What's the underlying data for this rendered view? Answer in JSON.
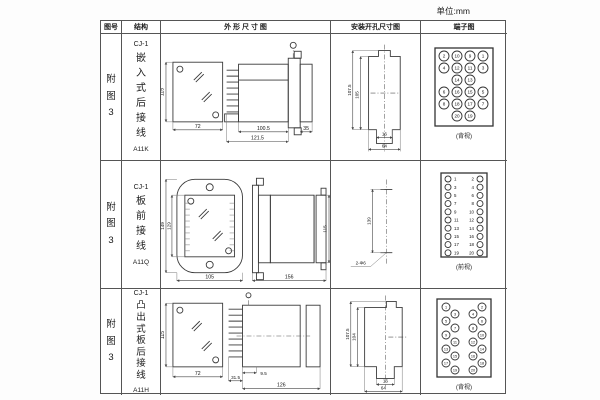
{
  "unit_label": "单位:mm",
  "table": {
    "headers": [
      "图号",
      "结构",
      "外 形 尺 寸 图",
      "安装开孔尺寸图",
      "端子图"
    ]
  },
  "rows": [
    {
      "fig_no": "附图3",
      "structure": {
        "model": "CJ-1",
        "type": "嵌入式后接线",
        "code": "A11K"
      },
      "outline": {
        "front_h": "115",
        "front_w": "72",
        "body": "100.5",
        "total": "121.5",
        "flange": "35"
      },
      "install": {
        "v1": "107.5",
        "v2": "105",
        "w1": "16",
        "w2": "64"
      },
      "terminal": {
        "caption": "(背视)"
      }
    },
    {
      "fig_no": "附图3",
      "structure": {
        "model": "CJ-1",
        "type": "板前接线",
        "code": "A11Q"
      },
      "outline": {
        "v1": "149",
        "v2": "129",
        "w": "105",
        "side_w": "156",
        "side_h": "115"
      },
      "install": {
        "dist": "139",
        "holes": "2-Φ6"
      },
      "terminal": {
        "caption": "(前视)"
      }
    },
    {
      "fig_no": "附图3",
      "structure": {
        "model": "CJ-1",
        "type": "凸出式板后接线",
        "code": "A11H"
      },
      "outline": {
        "front_h": "115",
        "front_w": "72",
        "a": "31.5",
        "b": "9.5",
        "total": "126"
      },
      "install": {
        "v1": "107.5",
        "v2": "104",
        "w1": "16",
        "w2": "64"
      },
      "terminal": {
        "caption": "(背视)"
      }
    }
  ],
  "terminal_layouts": {
    "term1": {
      "r": 5,
      "font": 4.6,
      "cells": [
        [
          23,
          22,
          "2"
        ],
        [
          36,
          22,
          "10"
        ],
        [
          49,
          22,
          "9"
        ],
        [
          62,
          22,
          "1"
        ],
        [
          23,
          34,
          "4"
        ],
        [
          36,
          34,
          "12"
        ],
        [
          49,
          34,
          "11"
        ],
        [
          62,
          34,
          "3"
        ],
        [
          36,
          46,
          "14"
        ],
        [
          49,
          46,
          "13"
        ],
        [
          23,
          58,
          "6"
        ],
        [
          36,
          58,
          "16"
        ],
        [
          49,
          58,
          "15"
        ],
        [
          62,
          58,
          "5"
        ],
        [
          23,
          70,
          "8"
        ],
        [
          36,
          70,
          "18"
        ],
        [
          49,
          70,
          "17"
        ],
        [
          62,
          70,
          "7"
        ],
        [
          36,
          82,
          "20"
        ],
        [
          49,
          82,
          "19"
        ]
      ]
    },
    "term2": {
      "r": 3,
      "font": 4.4,
      "cells": [
        [
          27,
          18,
          "1",
          33,
          "start"
        ],
        [
          59,
          18,
          "2",
          53,
          "end"
        ],
        [
          27,
          26.2,
          "3",
          33,
          "start"
        ],
        [
          59,
          26.2,
          "4",
          53,
          "end"
        ],
        [
          27,
          34.4,
          "5",
          33,
          "start"
        ],
        [
          59,
          34.4,
          "6",
          53,
          "end"
        ],
        [
          27,
          42.6,
          "7",
          33,
          "start"
        ],
        [
          59,
          42.6,
          "8",
          53,
          "end"
        ],
        [
          27,
          50.8,
          "9",
          33,
          "start"
        ],
        [
          59,
          50.8,
          "10",
          53,
          "end"
        ],
        [
          27,
          59,
          "11",
          33,
          "start"
        ],
        [
          59,
          59,
          "12",
          53,
          "end"
        ],
        [
          27,
          67.2,
          "13",
          33,
          "start"
        ],
        [
          59,
          67.2,
          "14",
          53,
          "end"
        ],
        [
          27,
          75.4,
          "15",
          33,
          "start"
        ],
        [
          59,
          75.4,
          "16",
          53,
          "end"
        ],
        [
          27,
          83.6,
          "17",
          33,
          "start"
        ],
        [
          59,
          83.6,
          "18",
          53,
          "end"
        ],
        [
          27,
          91.8,
          "19",
          33,
          "start"
        ],
        [
          59,
          91.8,
          "20",
          53,
          "end"
        ]
      ]
    },
    "term3": {
      "r": 4,
      "font": 3.8,
      "cells": [
        [
          25,
          18,
          "1"
        ],
        [
          34,
          25,
          "3"
        ],
        [
          25,
          32,
          "5"
        ],
        [
          34,
          39,
          "7"
        ],
        [
          25,
          46,
          "9"
        ],
        [
          34,
          53,
          "11"
        ],
        [
          25,
          60,
          "13"
        ],
        [
          34,
          67,
          "15"
        ],
        [
          25,
          74,
          "17"
        ],
        [
          34,
          81,
          "19"
        ],
        [
          61,
          18,
          "2"
        ],
        [
          52,
          25,
          "4"
        ],
        [
          61,
          32,
          "6"
        ],
        [
          52,
          39,
          "8"
        ],
        [
          61,
          46,
          "10"
        ],
        [
          52,
          53,
          "12"
        ],
        [
          61,
          60,
          "14"
        ],
        [
          52,
          67,
          "16"
        ],
        [
          61,
          74,
          "18"
        ],
        [
          52,
          81,
          "20"
        ]
      ]
    }
  }
}
